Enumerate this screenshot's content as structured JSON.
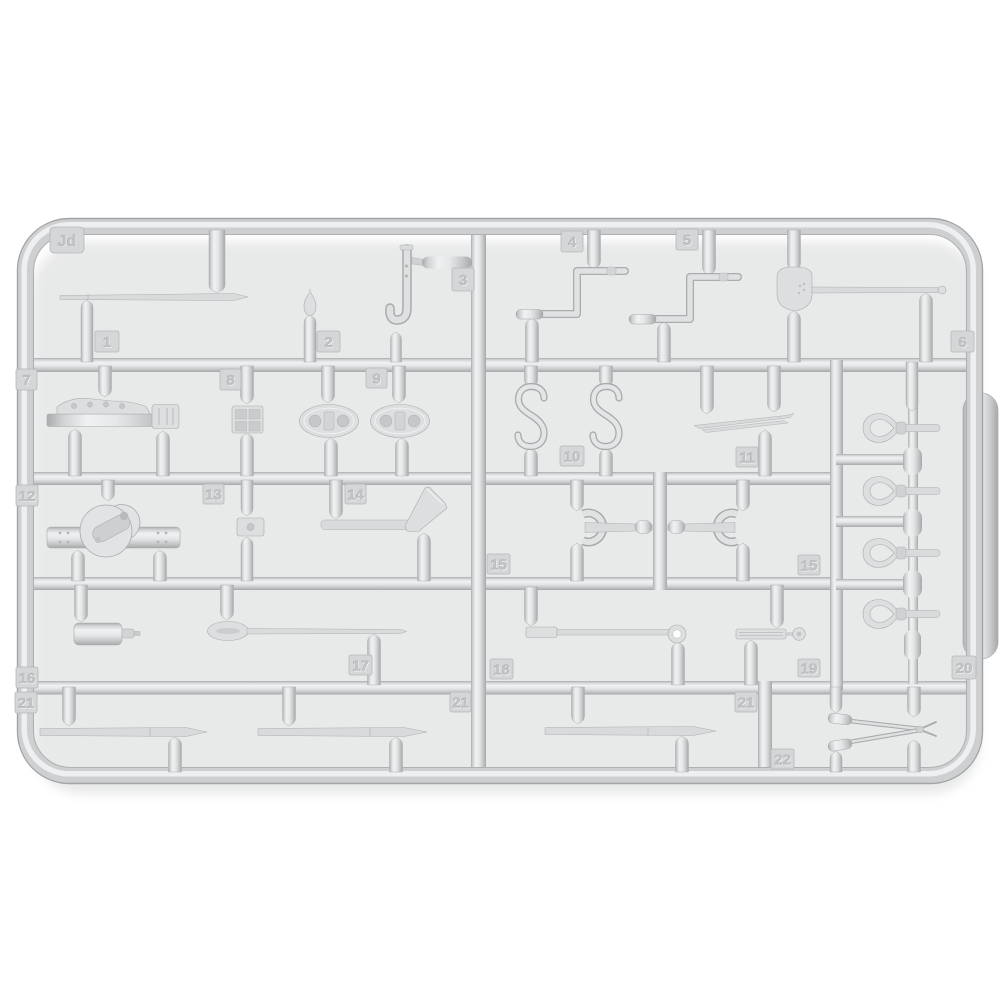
{
  "scene": {
    "description": "Light gray injection-molded plastic model kit sprue (parts tree) photographed on a white background",
    "background_color": "#ffffff",
    "plastic_base_color": "#d6d8da",
    "plastic_highlight_color": "#f1f2f3",
    "plastic_shadow_color": "#a7a9ab",
    "tag_plate_color": "#d4d6d8",
    "tag_text_color": "#c2c4c6"
  },
  "sprue": {
    "code_label": "Jd",
    "tags": [
      {
        "label": "Jd"
      },
      {
        "label": "1"
      },
      {
        "label": "2"
      },
      {
        "label": "3"
      },
      {
        "label": "4"
      },
      {
        "label": "5"
      },
      {
        "label": "6"
      },
      {
        "label": "7"
      },
      {
        "label": "8"
      },
      {
        "label": "9"
      },
      {
        "label": "10"
      },
      {
        "label": "11"
      },
      {
        "label": "12"
      },
      {
        "label": "13"
      },
      {
        "label": "14"
      },
      {
        "label": "15"
      },
      {
        "label": "15"
      },
      {
        "label": "16"
      },
      {
        "label": "17"
      },
      {
        "label": "18"
      },
      {
        "label": "19"
      },
      {
        "label": "20"
      },
      {
        "label": "21"
      },
      {
        "label": "21"
      },
      {
        "label": "21"
      },
      {
        "label": "22"
      }
    ],
    "parts": [
      {
        "number": "1",
        "shape": "long thin pointed rod"
      },
      {
        "number": "2",
        "shape": "small pointed finial"
      },
      {
        "number": "3",
        "shape": "J-shaped hook"
      },
      {
        "number": "4",
        "shape": "Z-shaped crank handle"
      },
      {
        "number": "5",
        "shape": "Z-shaped crank handle"
      },
      {
        "number": "6",
        "shape": "shovel with long handle"
      },
      {
        "number": "7",
        "shape": "mounting bracket with holes"
      },
      {
        "number": "8",
        "shape": "2x2 grid plate"
      },
      {
        "number": "9",
        "shape": "oval shackle plate (x2)"
      },
      {
        "number": "10",
        "shape": "S-hook (x2)"
      },
      {
        "number": "11",
        "shape": "thin flat blade"
      },
      {
        "number": "12",
        "shape": "pulley block on strap"
      },
      {
        "number": "13",
        "shape": "small clamp block"
      },
      {
        "number": "14",
        "shape": "hatchet axe"
      },
      {
        "number": "15",
        "shape": "open-end wrench (x2)"
      },
      {
        "number": "16",
        "shape": "cylindrical canister"
      },
      {
        "number": "17",
        "shape": "oar-shaped paddle tool"
      },
      {
        "number": "18",
        "shape": "flat rod with eye ring"
      },
      {
        "number": "19",
        "shape": "short ribbed bar with knob"
      },
      {
        "number": "20",
        "shape": "cable thimble eye (x4)"
      },
      {
        "number": "21",
        "shape": "pointed cleaning rod (x3)"
      },
      {
        "number": "22",
        "shape": "folded dividers / shears"
      }
    ]
  }
}
